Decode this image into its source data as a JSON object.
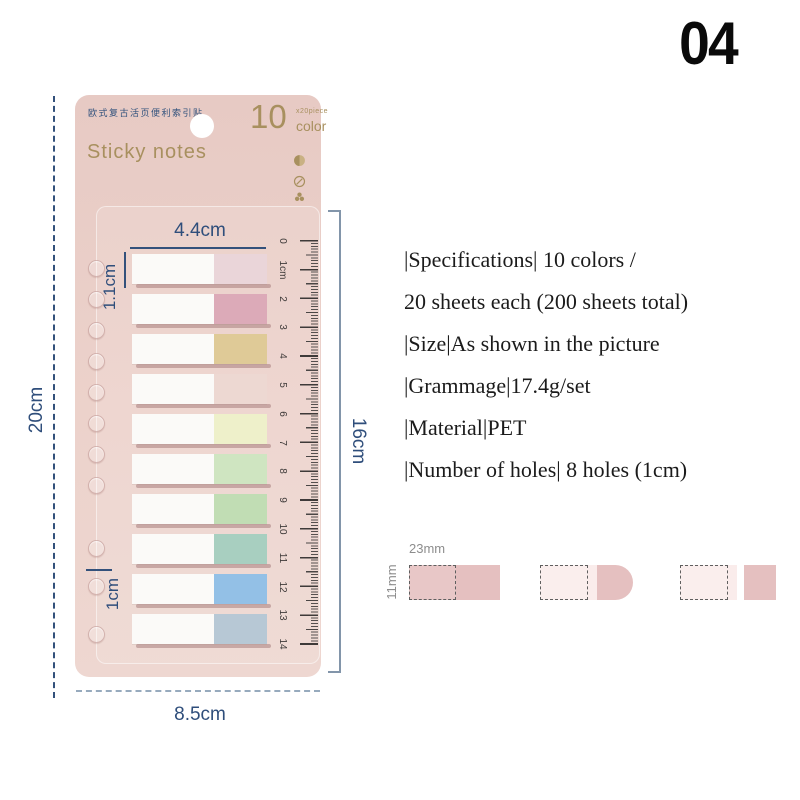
{
  "page_number": "04",
  "card": {
    "cn_title": "欧式复古活页便利索引贴",
    "badge": {
      "count": "10",
      "piece": "x20piece",
      "unit": "color"
    },
    "title": "Sticky notes",
    "icons": [
      "half-moon-icon",
      "pencil-circle-icon",
      "trefoil-icon"
    ]
  },
  "strips": {
    "white_color": "#fbfaf8",
    "tab_colors": [
      "#ead5d9",
      "#dcaab8",
      "#dfca97",
      "#edd8d2",
      "#eef0ca",
      "#cfe5c1",
      "#c1ddb4",
      "#a8cfc0",
      "#93c0e6",
      "#b7c8d5"
    ]
  },
  "ruler": {
    "labels": [
      "0",
      "1cm",
      "2",
      "3",
      "4",
      "5",
      "6",
      "7",
      "8",
      "9",
      "10",
      "11",
      "12",
      "13",
      "14"
    ]
  },
  "dimensions": {
    "tab_width": "4.4cm",
    "tab_height": "1.1cm",
    "card_height": "20cm",
    "ruler_span": "16cm",
    "hole_spacing": "1cm",
    "card_width": "8.5cm"
  },
  "specs": {
    "lines": [
      "|Specifications| 10 colors /",
      "20 sheets each (200 sheets total)",
      "|Size|As shown in the picture",
      "|Grammage|17.4g/set",
      "|Material|PET",
      "|Number of holes| 8 holes (1cm)"
    ]
  },
  "diagram": {
    "width_label": "23mm",
    "height_label": "11mm"
  },
  "colors": {
    "card_pink": "#e9cdc7",
    "navy": "#2f4e7b",
    "gold": "#a8905f",
    "ruler_ink": "#3e3a39",
    "diagram_pink": "#e5c0c0",
    "diagram_light": "#faeceb",
    "bracket": "#8295aa"
  }
}
